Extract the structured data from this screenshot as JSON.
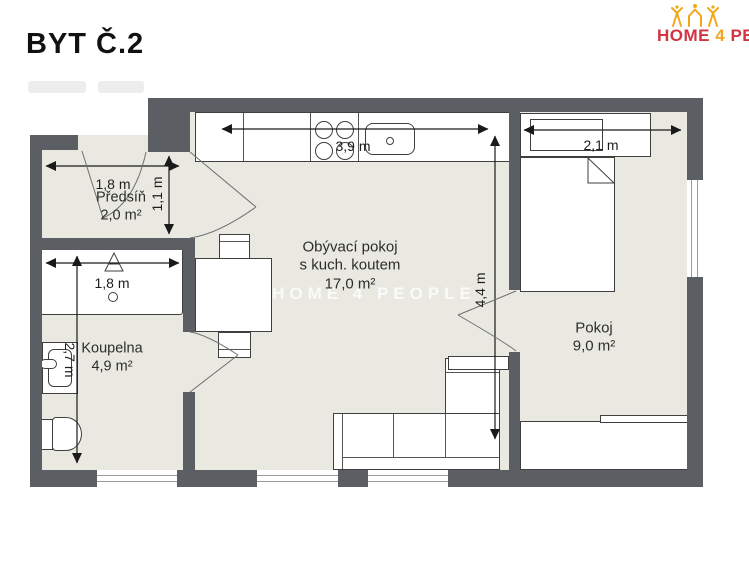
{
  "title": "BYT Č.2",
  "logo": {
    "home": "HOME",
    "four": "4",
    "people": "PEOP"
  },
  "watermark": "HOME 4 PEOPLE",
  "rooms": {
    "predsin": {
      "name": "Předsíň",
      "area": "2,0 m²"
    },
    "koupelna": {
      "name": "Koupelna",
      "area": "4,9 m²"
    },
    "obyvak": {
      "name_line1": "Obývací pokoj",
      "name_line2": "s kuch. koutem",
      "area": "17,0 m²"
    },
    "pokoj": {
      "name": "Pokoj",
      "area": "9,0 m²"
    }
  },
  "dimensions": {
    "predsin_width": "1,8 m",
    "predsin_height": "1,1 m",
    "koupelna_width": "1,8 m",
    "koupelna_height": "2,7 m",
    "kitchen_width": "3,9 m",
    "living_height": "4,4 m",
    "pokoj_width": "2,1 m"
  },
  "colors": {
    "wall": "#5b5f63",
    "floor": "#e9e9e1",
    "logo_red": "#d23440",
    "logo_gold": "#f2a71b",
    "outline": "#3f3f3f"
  }
}
